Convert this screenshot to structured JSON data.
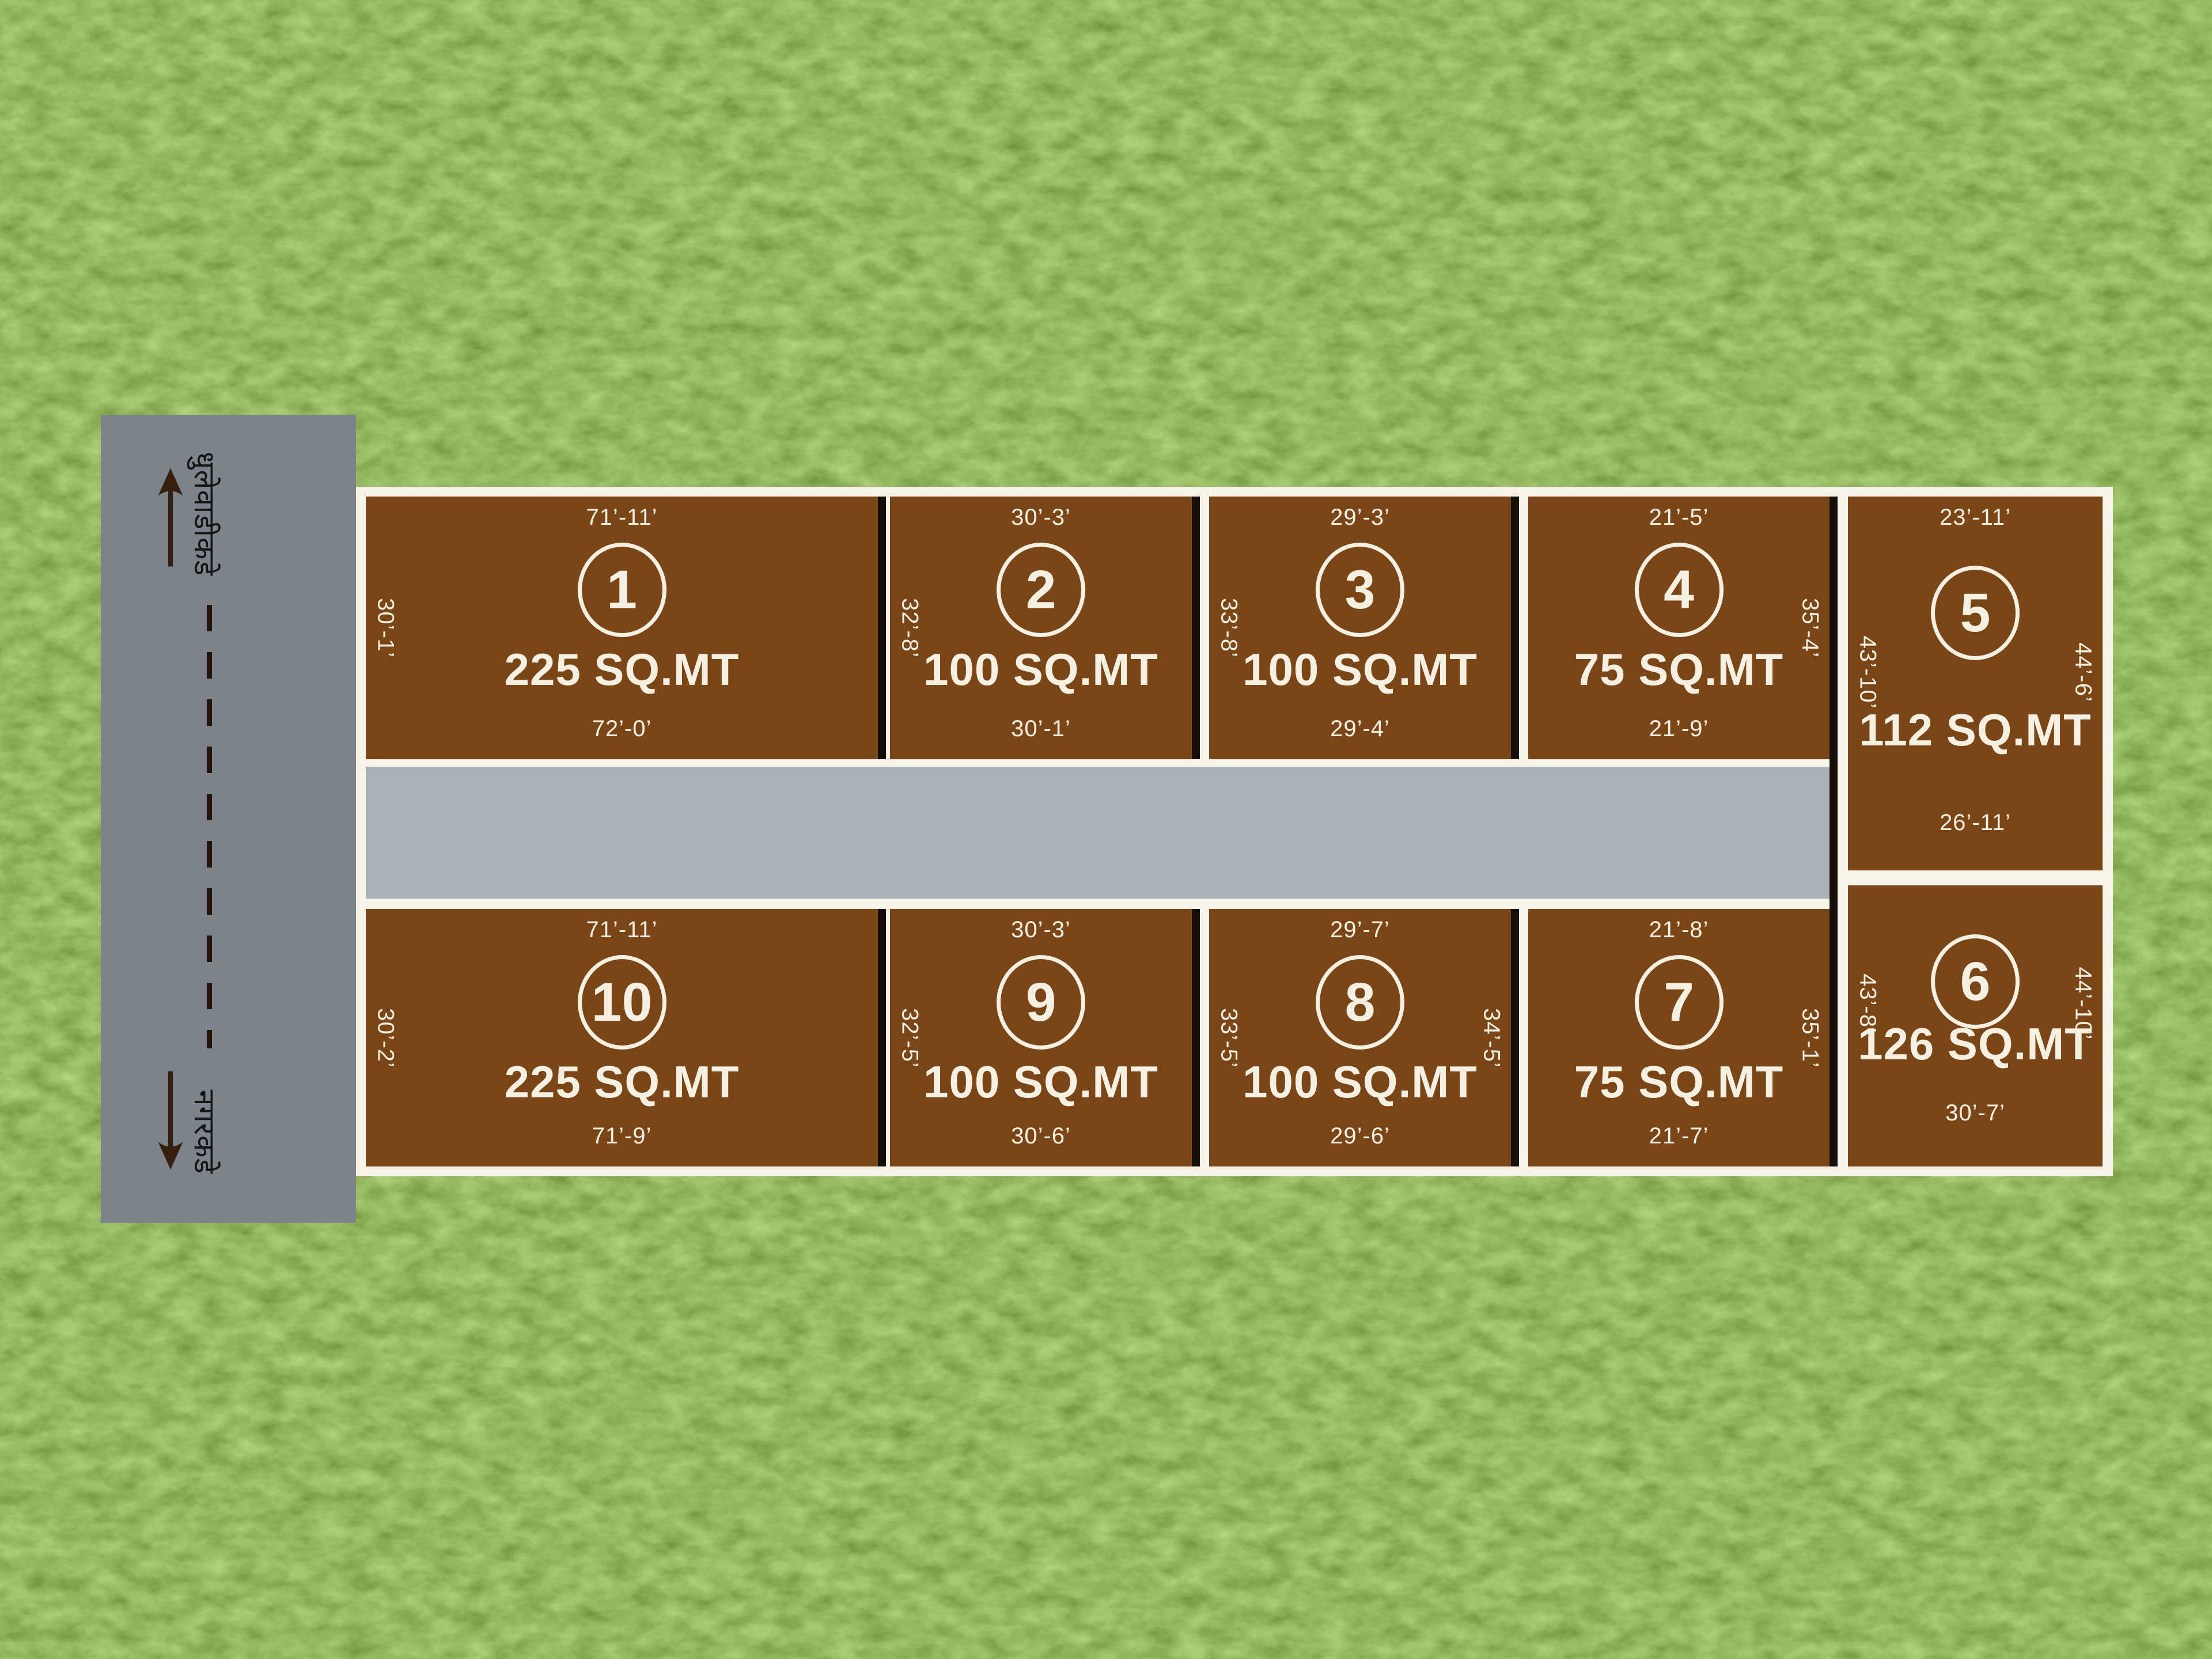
{
  "left_road": {
    "top_direction_label": "धुलेवाडीकडे",
    "bottom_direction_label": "नगरकडे",
    "up_arrow_icon": "up-arrow",
    "down_arrow_icon": "down-arrow"
  },
  "plots": [
    {
      "number": "1",
      "area": "225 SQ.MT",
      "top_dim": "71’-11’",
      "left_dim": "30’-1’",
      "bottom_dim": "72’-0’"
    },
    {
      "number": "2",
      "area": "100 SQ.MT",
      "top_dim": "30’-3’",
      "left_dim": "32’-8’",
      "bottom_dim": "30’-1’"
    },
    {
      "number": "3",
      "area": "100 SQ.MT",
      "top_dim": "29’-3’",
      "left_dim": "33’-8’",
      "bottom_dim": "29’-4’"
    },
    {
      "number": "4",
      "area": "75 SQ.MT",
      "top_dim": "21’-5’",
      "right_dim": "35’-4’",
      "bottom_dim": "21’-9’"
    },
    {
      "number": "5",
      "area": "112 SQ.MT",
      "top_dim": "23’-11’",
      "left_dim": "43’-10’",
      "right_dim": "44’-6’",
      "bottom_dim": "26’-11’"
    },
    {
      "number": "6",
      "area": "126 SQ.MT",
      "left_dim": "43’-8’",
      "right_dim": "44’-10’",
      "bottom_dim": "30’-7’"
    },
    {
      "number": "7",
      "area": "75 SQ.MT",
      "top_dim": "21’-8’",
      "right_dim": "35’-1’",
      "bottom_dim": "21’-7’"
    },
    {
      "number": "8",
      "area": "100 SQ.MT",
      "top_dim": "29’-7’",
      "left_dim": "33’-5’",
      "right_dim": "34’-5’",
      "bottom_dim": "29’-6’"
    },
    {
      "number": "9",
      "area": "100 SQ.MT",
      "top_dim": "30’-3’",
      "left_dim": "32’-5’",
      "bottom_dim": "30’-6’"
    },
    {
      "number": "10",
      "area": "225 SQ.MT",
      "top_dim": "71’-11’",
      "left_dim": "30’-2’",
      "bottom_dim": "71’-9’"
    }
  ],
  "colors": {
    "grass_green": "#4e7a1f",
    "plot_brown": "#7a4517",
    "outline_cream": "#f7f3e9",
    "vertical_road_gray": "#7d838a",
    "internal_road_gray": "#a9b1b6",
    "divider_black": "#170f08",
    "arrow_brown": "#35200f",
    "label_cream": "#f6f0e3"
  }
}
